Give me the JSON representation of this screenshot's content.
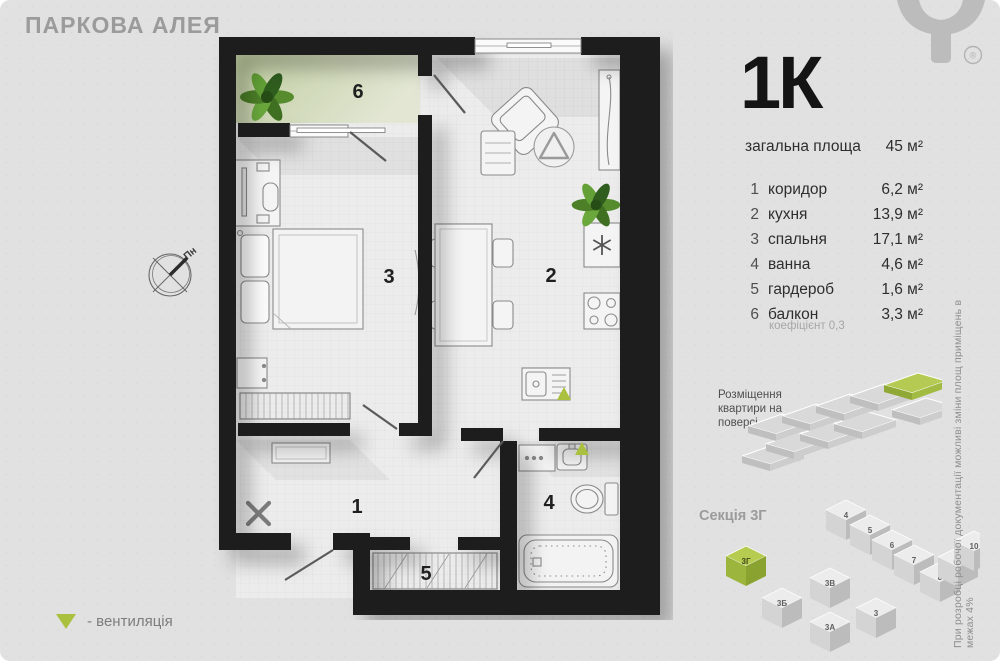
{
  "header": {
    "project_title": "ПАРКОВА АЛЕЯ",
    "registered_mark": "®"
  },
  "apartment": {
    "type_label": "1К",
    "total_area_label": "загальна площа",
    "total_area_value": "45 м²",
    "rooms": [
      {
        "num": "1",
        "name": "коридор",
        "area": "6,2 м²"
      },
      {
        "num": "2",
        "name": "кухня",
        "area": "13,9 м²"
      },
      {
        "num": "3",
        "name": "спальня",
        "area": "17,1 м²"
      },
      {
        "num": "4",
        "name": "ванна",
        "area": "4,6 м²"
      },
      {
        "num": "5",
        "name": "гардероб",
        "area": "1,6 м²"
      },
      {
        "num": "6",
        "name": "балкон",
        "area": "3,3 м²"
      }
    ],
    "coefficient_note": "коефіцієнт 0,3"
  },
  "plan": {
    "labels": {
      "r1": "1",
      "r2": "2",
      "r3": "3",
      "r4": "4",
      "r5": "5",
      "r6": "6"
    },
    "compass_label": "Пн"
  },
  "floor_position": {
    "line1": "Розміщення",
    "line2": "квартири на",
    "line3": "поверсі"
  },
  "section": {
    "label": "Секція 3Г",
    "blocks": {
      "b3g": "3Г",
      "b3b": "3Б",
      "b3v": "3В",
      "b3a": "3А",
      "b3": "3",
      "b4": "4",
      "b5": "5",
      "b6": "6",
      "b7": "7",
      "b8": "8",
      "b9": "9",
      "b10": "10"
    }
  },
  "legend": {
    "vent_label": "- вентиляція"
  },
  "footnote": "При розробці робочої документації можливі зміни площ приміщень в межах 4%",
  "colors": {
    "accent_green": "#a9c13e",
    "wall": "#1d1d1d",
    "balcony_green": "#c5d1a5"
  }
}
